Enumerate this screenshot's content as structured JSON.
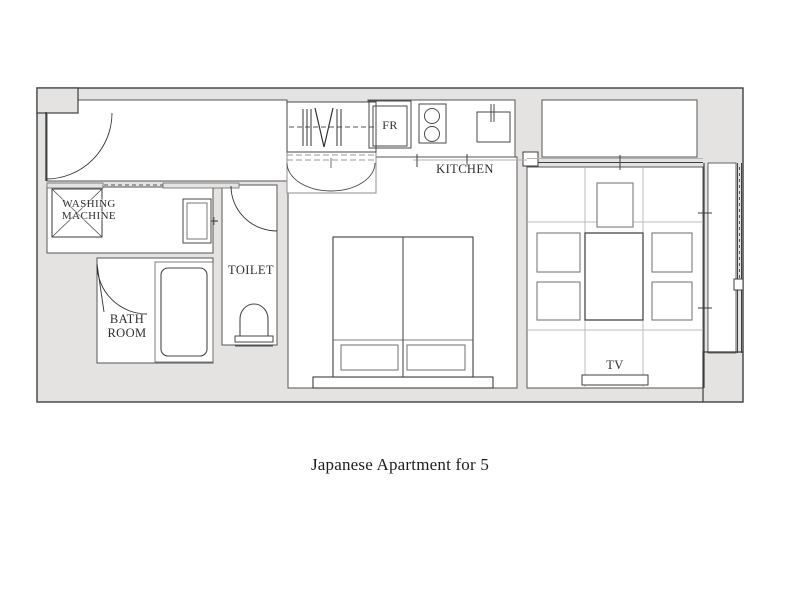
{
  "caption": "Japanese Apartment for 5",
  "plan": {
    "labels": {
      "washing_machine": "WASHING\nMACHINE",
      "bath_room": "BATH\nROOM",
      "toilet": "TOILET",
      "kitchen": "KITCHEN",
      "fridge": "FR",
      "tv": "TV"
    },
    "colors": {
      "wall_fill": "#e5e3e1",
      "wall_outline": "#3f3f3f",
      "fixture_line": "#4a4a4a",
      "light_line": "#b3b3b3",
      "text": "#2e2e2e"
    },
    "fixtures": [
      "entry-door-swing",
      "washing-machine",
      "vanity-sink",
      "bathtub",
      "bathroom-door-swing",
      "toilet-bowl",
      "toilet-door-swing",
      "closet-hanger-rod",
      "closet-double-doors",
      "refrigerator",
      "stove-burners",
      "kitchen-sink",
      "wardrobe-closet",
      "double-bed",
      "pillows",
      "floor-table",
      "floor-cushions",
      "tv-stand",
      "balcony-sliding-window"
    ]
  }
}
